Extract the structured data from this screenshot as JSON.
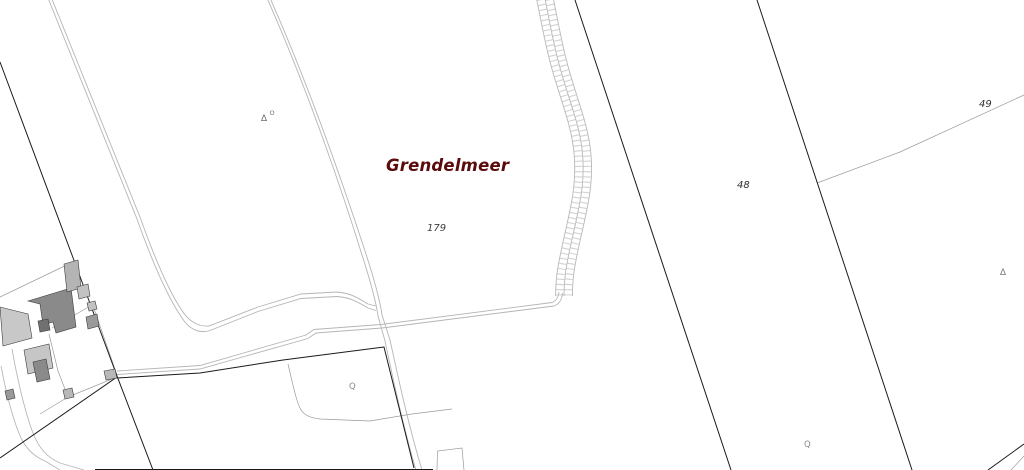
{
  "map": {
    "place_label": "Grendelmeer",
    "parcel_numbers": {
      "field": "179",
      "strip": "48",
      "far": "49"
    },
    "symbols": {
      "marker_triangle": "∆",
      "marker_sup": "O",
      "well": "Q"
    },
    "colors": {
      "background": "#ffffff",
      "place_label_text": "#5a0b0b",
      "parcel_number_text": "#333333",
      "symbol_gray": "#7a7a7a",
      "boundary_black": "#1a1a1a",
      "boundary_gray": "#9a9a9a",
      "road_casing": "#b5b5b5",
      "embankment_rail": "#b8b8b8",
      "embankment_rung": "#d2d2d2",
      "building_dark": "#8a8a8a",
      "building_light": "#c6c6c6"
    }
  }
}
